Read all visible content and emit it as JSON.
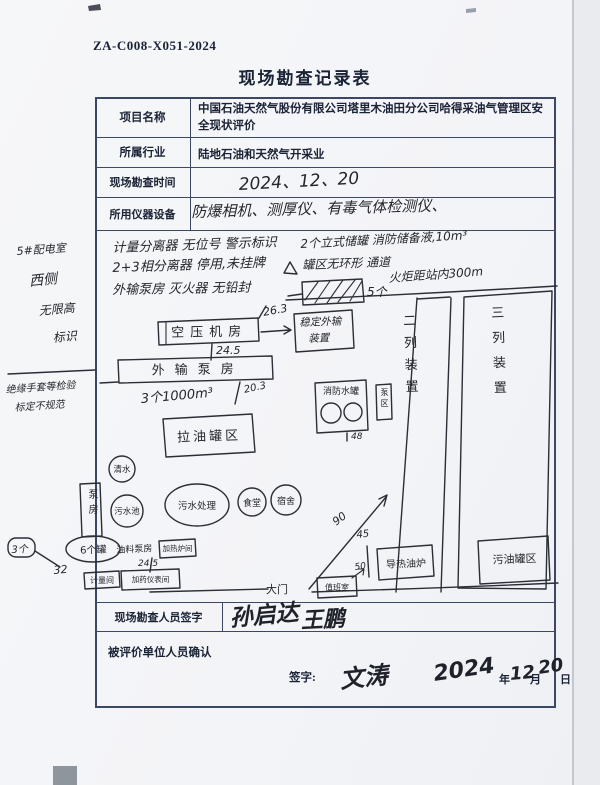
{
  "page": {
    "doc_number": "ZA-C008-X051-2024",
    "title": "现场勘查记录表"
  },
  "form": {
    "row1": {
      "label": "项目名称",
      "value": "中国石油天然气股份有限公司塔里木油田分公司哈得采油气管理区安全现状评价"
    },
    "row2": {
      "label": "所属行业",
      "value": "陆地石油和天然气开采业"
    },
    "row3": {
      "label": "现场勘查时间",
      "value": "2024、12、20"
    },
    "row4": {
      "label": "所用仪器设备",
      "value": "防爆相机、测厚仪、有毒气体检测仪、"
    },
    "surveyor": {
      "label": "现场勘查人员签字",
      "sig1": "孙启达",
      "sig2": "王鹏"
    },
    "confirm": {
      "label": "被评价单位人员确认",
      "sign_label": "签字:",
      "signature": "文涛",
      "year": "2024",
      "year_unit": "年",
      "month": "12",
      "month_unit": "月",
      "day": "20",
      "day_unit": "日"
    }
  },
  "margin": {
    "l1": "5#配电室",
    "l2": "西侧",
    "l3": "无限高",
    "l4": "标识",
    "l5": "绝缘手套等检验",
    "l6": "标定不规范",
    "box": "3个",
    "num": "32"
  },
  "sketch": {
    "notes": {
      "n1": "计量分离器 无位号 警示标识",
      "n2": "2+3相分离器 停用,未挂牌",
      "n3": "外输泵房 灭火器 无铅封",
      "n4": "2个立式储罐 消防储备液,10m³",
      "n5": "罐区无环形 通道",
      "n6": "火炬距站内300m"
    },
    "labels": {
      "heater_count": "5个",
      "air_comp": "空压机房",
      "dist1": "26.3",
      "target_l1": "稳定外输",
      "target_l2": "装置",
      "dist2": "24.5",
      "pump_house": "外输泵房",
      "tanks": "3个1000m³",
      "dist3": "20.3",
      "oil_tank_area": "拉油罐区",
      "c1": "清水",
      "c2": "污水池",
      "c3": "污水处理",
      "c4": "食堂",
      "c5": "宿舍",
      "pump_room": "泵房",
      "fire_tank": "消防水罐",
      "dist4": "48",
      "small_box": "泵区",
      "train2": "二列装置",
      "train3": "三列装置",
      "dist5": "90",
      "dist6": "45",
      "dist7": "50",
      "boiler": "导热油炉",
      "waste_tank": "污油罐区",
      "gate": "大门",
      "guard": "值班室",
      "oval6": "6个罐",
      "oil_pump": "油料泵房",
      "heater_room": "加热炉间",
      "dist8": "24.5",
      "meter_room": "计量间",
      "dosing_room": "加药仪表间"
    }
  }
}
